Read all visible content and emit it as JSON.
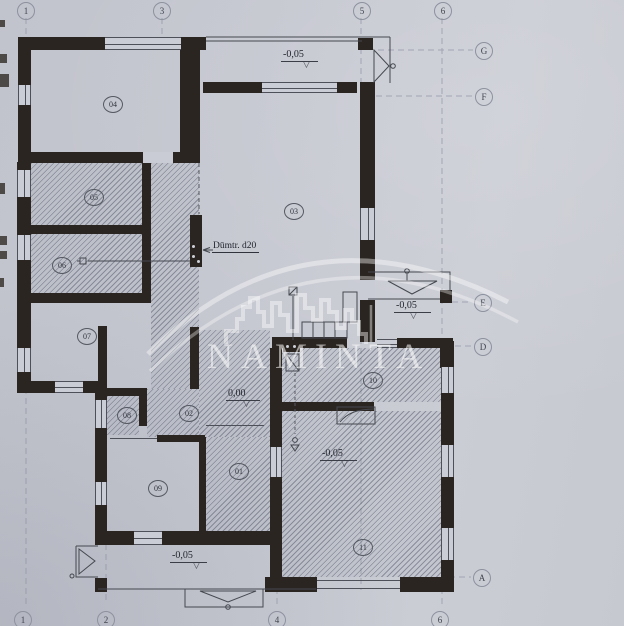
{
  "watermark": {
    "brand": "NAMINTA"
  },
  "grid": {
    "top": [
      "1",
      "3",
      "5",
      "6"
    ],
    "bottom": [
      "1",
      "2",
      "4",
      "6"
    ],
    "right": [
      "G",
      "F",
      "E",
      "D",
      "A"
    ]
  },
  "rooms": [
    "04",
    "05",
    "06",
    "07",
    "03",
    "08",
    "02",
    "09",
    "01",
    "10",
    "11"
  ],
  "labels": {
    "chimney": "Dūmtr. d20",
    "level_north": "-0,05",
    "level_east": "-0,05",
    "level_hall": "0,00",
    "level_room11": "-0,05",
    "level_south": "-0,05",
    "level_triangle": "▽"
  },
  "colors": {
    "wall": "#2a2521",
    "paper": "#c7c9d1",
    "line": "#4d5058",
    "watermark": "#ffffff"
  }
}
